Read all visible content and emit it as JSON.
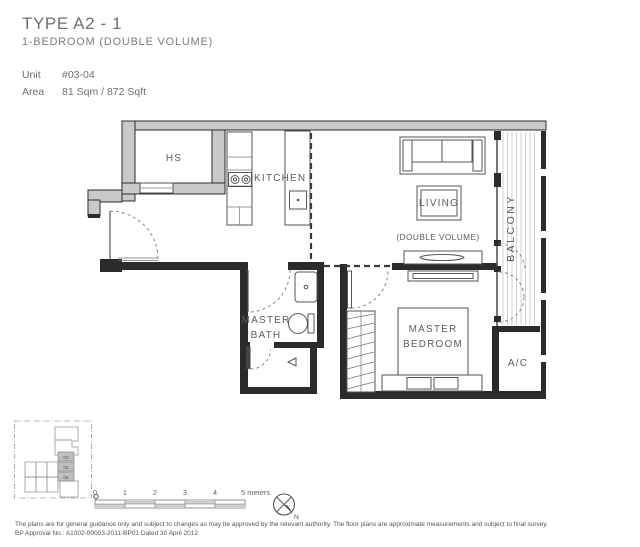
{
  "header": {
    "title": "TYPE A2 - 1",
    "subtitle": "1-BEDROOM (DOUBLE VOLUME)",
    "unit_label": "Unit",
    "unit_value": "#03-04",
    "area_label": "Area",
    "area_value": "81 Sqm / 872 Sqft"
  },
  "plan_labels": {
    "hs": "HS",
    "kitchen": "KITCHEN",
    "living": "LIVING",
    "double_volume": "(DOUBLE VOLUME)",
    "balcony": "BALCONY",
    "master_bath": [
      "MASTER",
      "BATH"
    ],
    "master_bedroom": [
      "MASTER",
      "BEDROOM"
    ],
    "ac": "A/C"
  },
  "keyplan": {
    "stack_labels": [
      "03",
      "04",
      "05"
    ]
  },
  "scalebar": {
    "ticks": [
      "0",
      "1",
      "2",
      "3",
      "4"
    ],
    "end_label": "5 meters"
  },
  "compass": {
    "north_label": "N"
  },
  "footer": {
    "line1": "The plans are for general guidance only and subject to changes as may be approved by the relevant authority. The floor plans are approximate measurements and subject to final survey.",
    "line2": "BP Approval No.: A1002-00003-2011-BP01 Dated 30 April 2012"
  },
  "colors": {
    "wall_dark": "#2b2b2b",
    "wall_gray_fill": "#c9c9c9",
    "text_gray": "#6e6e6e"
  }
}
